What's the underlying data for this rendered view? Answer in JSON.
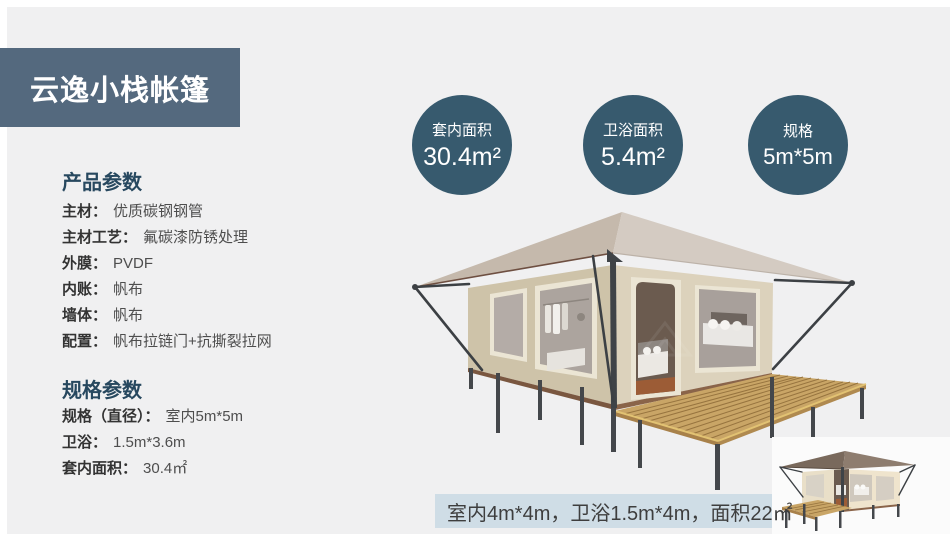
{
  "page": {
    "title": "云逸小栈帐篷"
  },
  "stats": [
    {
      "label": "套内面积",
      "value": "30.4m²"
    },
    {
      "label": "卫浴面积",
      "value": "5.4m²"
    },
    {
      "label": "规格",
      "value": "5m*5m"
    }
  ],
  "product_params": {
    "heading": "产品参数",
    "items": [
      {
        "label": "主材：",
        "value": "优质碳钢钢管"
      },
      {
        "label": "主材工艺：",
        "value": "氟碳漆防锈处理"
      },
      {
        "label": "外膜：",
        "value": "PVDF"
      },
      {
        "label": "内账：",
        "value": "帆布"
      },
      {
        "label": "墙体：",
        "value": "帆布"
      },
      {
        "label": "配置：",
        "value": "帆布拉链门+抗撕裂拉网"
      }
    ]
  },
  "spec_params": {
    "heading": "规格参数",
    "items": [
      {
        "label": "规格（直径）：",
        "value": "室内5m*5m"
      },
      {
        "label": "卫浴：",
        "value": "1.5m*3.6m"
      },
      {
        "label": "套内面积：",
        "value": "30.4㎡"
      }
    ]
  },
  "caption": {
    "text": "室内4m*4m，卫浴1.5m*4m，面积22㎡"
  },
  "illustrations": {
    "main": "glamping-tent-render",
    "mini": "glamping-tent-small-render"
  },
  "colors": {
    "title_band": "#54697e",
    "stat_circle": "#375a6e",
    "section_heading": "#27485f",
    "caption_bg": "#cfdde6",
    "page_bg": "#f0f0f1"
  }
}
